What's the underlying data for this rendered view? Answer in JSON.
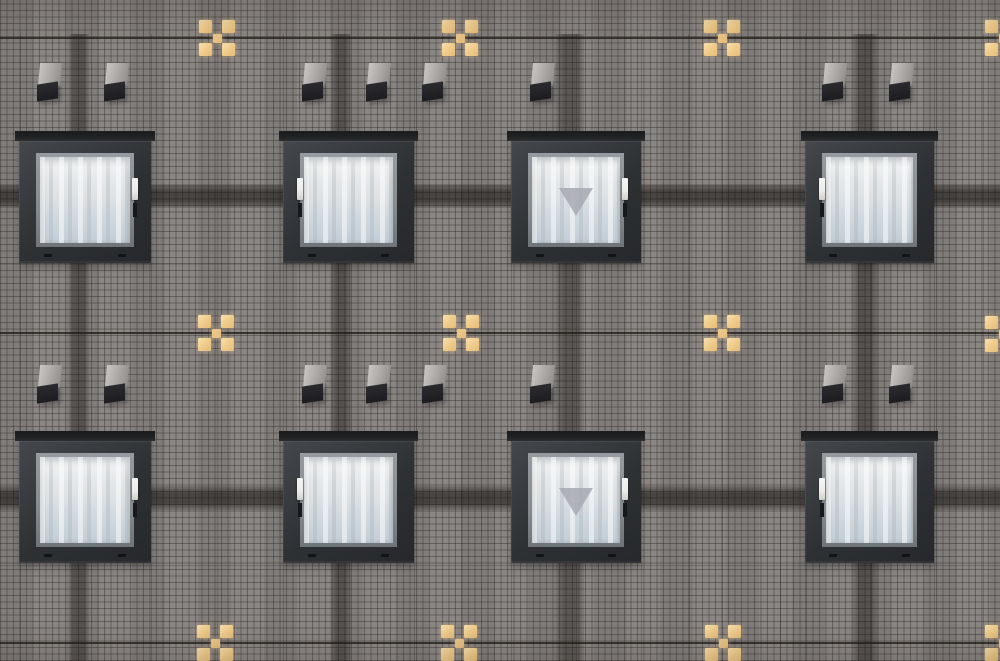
{
  "scene": {
    "description": "Photograph of a dark grey mosaic-tiled building facade with two rows of four square hotel windows with white curtains, pairs of small wall vent hoods above each row, thin dark joint lines, dark vertical and horizontal tile bands, and decorative amber cross-shaped tile motifs; the third window in each row bears a pale downward-pointing emergency-access triangle sticker",
    "width": 1000,
    "height": 661
  },
  "palette": {
    "wall": "#878381",
    "mortar": "rgba(48,44,41,0.42)",
    "panel_line": "rgba(25,22,20,0.22)",
    "accent_line": "rgba(28,25,22,0.75)",
    "cross_light": "#f8e0ae",
    "cross_mid": "#efca89",
    "cross_deep": "#e5bc7a",
    "cross_center": "#eecb8d",
    "vent_top_light": "#c9c7c5",
    "vent_top_dark": "#8f8c8a",
    "vent_face": "#1d1d21",
    "window_cap": "#202224",
    "frame_dark": "#2e3134",
    "frame_mid": "#44474b",
    "sash": "#858a8e",
    "glass_top": "#eaeced",
    "glass_bottom": "#c3cdd6",
    "curtain_light": "rgba(255,255,255,0.50)",
    "curtain_shade": "rgba(168,176,182,0.35)",
    "handle": "#ededeb",
    "latch": "#17181b",
    "marker": "rgba(167,169,176,0.85)"
  },
  "facade": {
    "tile_pitch_px": 6.5,
    "accent_lines_y": [
      38,
      333,
      643
    ],
    "sub_lines_y": [
      263,
      565
    ],
    "panel_lines_x": [
      20,
      151,
      217,
      283,
      349,
      414,
      461,
      511,
      576,
      641,
      688,
      722,
      780,
      805,
      870,
      934,
      983
    ],
    "v_bands": [
      {
        "x": 69,
        "w": 20
      },
      {
        "x": 331,
        "w": 20
      },
      {
        "x": 556,
        "w": 28
      },
      {
        "x": 852,
        "w": 26
      }
    ],
    "h_bands": [
      {
        "y": 184,
        "h": 24
      },
      {
        "y": 486,
        "h": 24
      }
    ]
  },
  "crosses": {
    "box": 36,
    "tiles": [
      {
        "x": 0,
        "y": 0,
        "w": 13,
        "h": 13,
        "role": "corner"
      },
      {
        "x": 23,
        "y": 0,
        "w": 13,
        "h": 13,
        "role": "corner"
      },
      {
        "x": 0,
        "y": 23,
        "w": 13,
        "h": 13,
        "role": "corner"
      },
      {
        "x": 23,
        "y": 23,
        "w": 13,
        "h": 13,
        "role": "corner"
      },
      {
        "x": 13.5,
        "y": 13.5,
        "w": 9,
        "h": 9,
        "role": "center"
      }
    ],
    "positions": [
      {
        "cx": 217,
        "cy": 38
      },
      {
        "cx": 460,
        "cy": 38
      },
      {
        "cx": 722,
        "cy": 38
      },
      {
        "cx": 1003,
        "cy": 38
      },
      {
        "cx": 216,
        "cy": 333
      },
      {
        "cx": 461,
        "cy": 333
      },
      {
        "cx": 722,
        "cy": 333
      },
      {
        "cx": 1003,
        "cy": 334
      },
      {
        "cx": 215,
        "cy": 643
      },
      {
        "cx": 459,
        "cy": 643
      },
      {
        "cx": 723,
        "cy": 643
      },
      {
        "cx": 1003,
        "cy": 643
      }
    ]
  },
  "vents": {
    "w": 25,
    "h": 38,
    "row_ys": [
      63,
      365
    ],
    "xs": [
      37,
      104,
      302,
      366,
      422,
      530,
      822,
      889
    ]
  },
  "windows": {
    "row_ys": [
      131,
      431
    ],
    "height": 132,
    "columns": [
      {
        "x": 19,
        "w": 132,
        "handle_side": "right",
        "has_marker": false
      },
      {
        "x": 283,
        "w": 131,
        "handle_side": "left",
        "has_marker": false
      },
      {
        "x": 511,
        "w": 130,
        "handle_side": "right",
        "has_marker": true
      },
      {
        "x": 805,
        "w": 129,
        "handle_side": "left",
        "has_marker": false
      }
    ],
    "weep_positions_pct": [
      22,
      78
    ]
  }
}
